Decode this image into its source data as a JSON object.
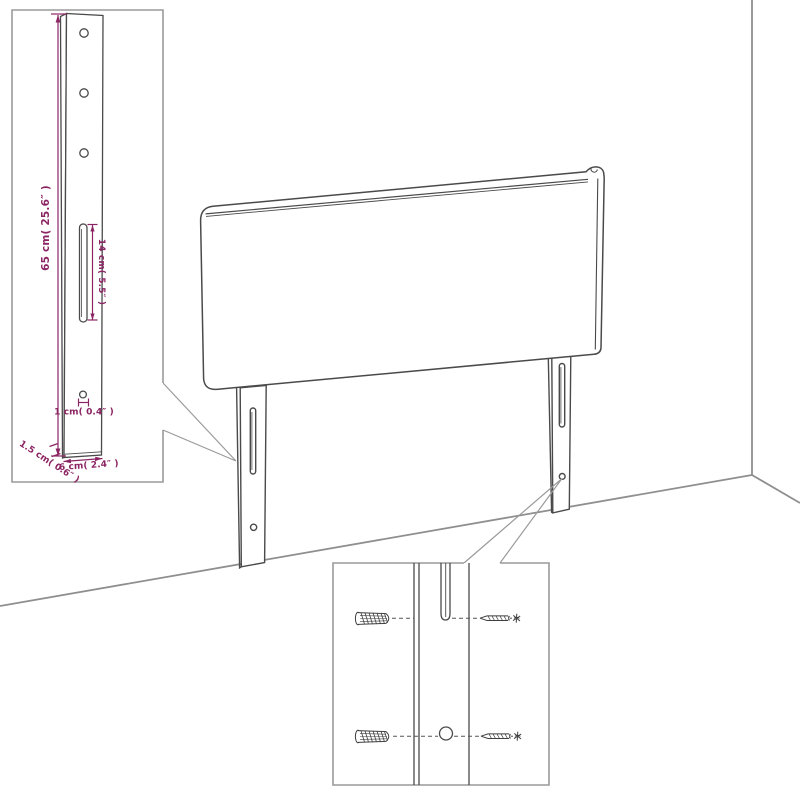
{
  "page": {
    "background": "#ffffff",
    "width": 800,
    "height": 800
  },
  "diagram": {
    "kind": "furniture-assembly-diagram",
    "subject": "upholstered headboard with two mounting legs placed against a room wall corner, with a leg dimension inset and a wall-mounting hardware inset",
    "colors": {
      "line": "#4a4a4a",
      "frame": "#9a9a9a",
      "wall": "#8f8f8f",
      "dimension_text": "#8b2463"
    },
    "leg_detail_inset": {
      "labels": {
        "height": "65 cm( 25.6″ )",
        "slot": "14 cm( 5.5″ )",
        "hole": "1 cm( 0.4″ )",
        "thickness": "1.5 cm( 0.6″ )",
        "width": "6 cm( 2.4″ )"
      }
    },
    "mounting_detail_inset": {
      "icons": {
        "anchor_top": "wall-plug-icon",
        "anchor_bottom": "wall-plug-icon",
        "screw_top": "screw-icon",
        "screw_bottom": "screw-icon"
      }
    }
  }
}
